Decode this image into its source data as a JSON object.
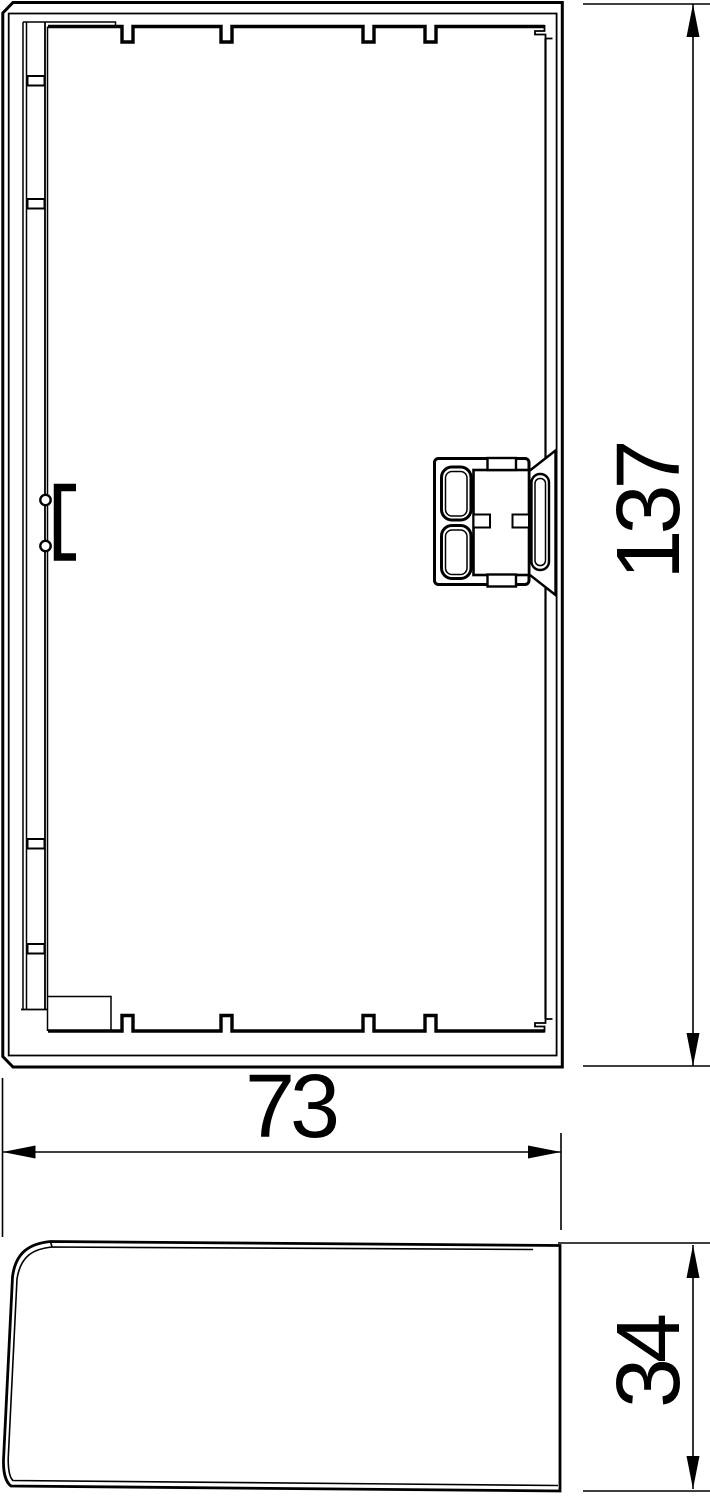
{
  "page": {
    "background": "#ffffff",
    "line_color": "#000000"
  },
  "drawing": {
    "kind": "technical-dimension-drawing",
    "views": {
      "front_view": "end-piece front view",
      "side_view": "end-piece side profile view"
    },
    "dimensions": {
      "height": {
        "value": "137",
        "orientation": "vertical"
      },
      "width": {
        "value": "73",
        "orientation": "horizontal"
      },
      "depth": {
        "value": "34",
        "orientation": "vertical"
      }
    }
  }
}
